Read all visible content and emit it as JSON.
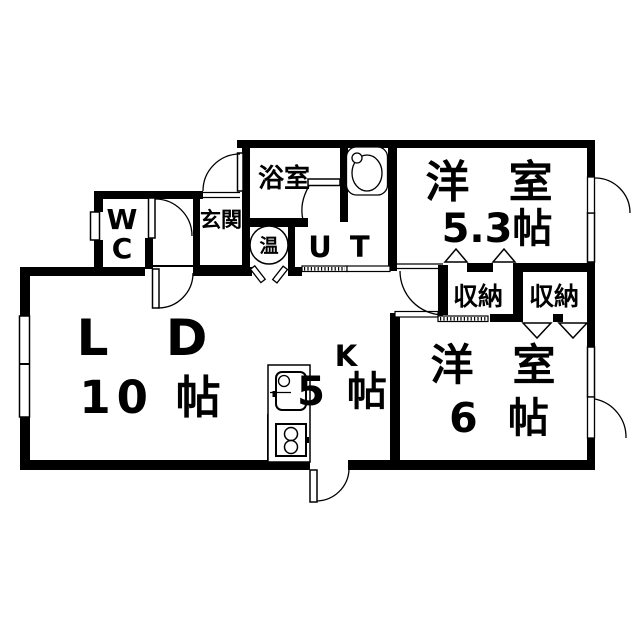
{
  "title": "apartment-floorplan",
  "colors": {
    "background": "#ffffff",
    "lines": "#000000"
  },
  "rooms": {
    "bathroom": {
      "label": "浴室"
    },
    "entrance": {
      "label": "玄関"
    },
    "toilet": {
      "line1": "W",
      "line2": "C"
    },
    "water_heater": {
      "label": "温"
    },
    "utility": {
      "label": "U T"
    },
    "bedroom_upper": {
      "label": "洋 室",
      "size": "5.3帖"
    },
    "storage_left": {
      "label": "収納"
    },
    "storage_right": {
      "label": "収納"
    },
    "living_dining": {
      "label": "L D",
      "size": "10 帖"
    },
    "kitchen": {
      "label": "K",
      "size": "5 帖"
    },
    "bedroom_lower": {
      "label": "洋 室",
      "size": "6 帖"
    }
  }
}
